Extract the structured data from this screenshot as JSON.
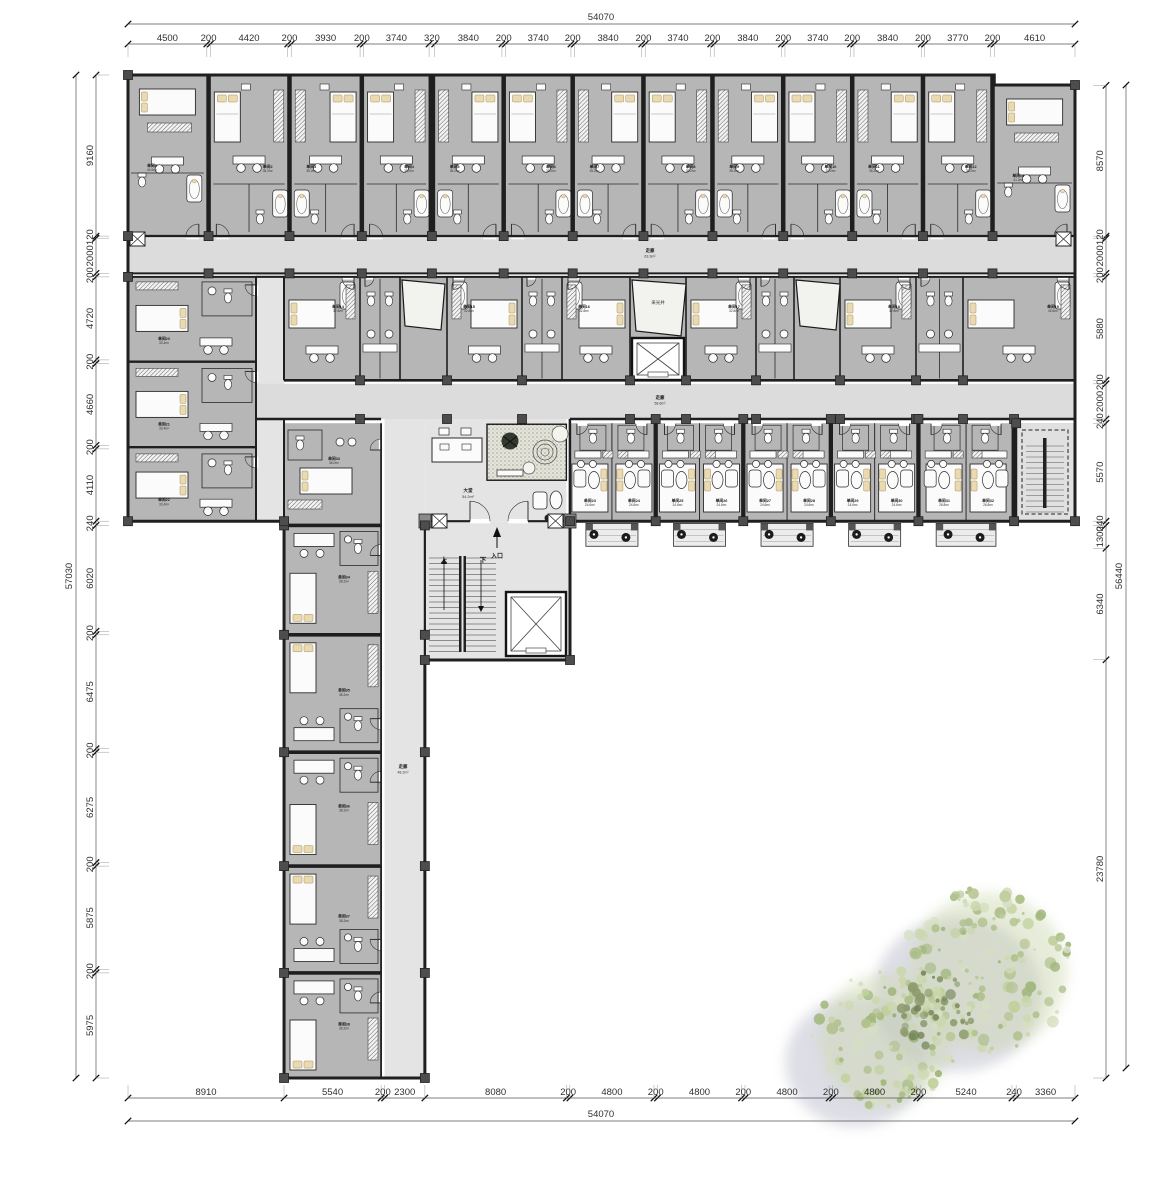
{
  "colors": {
    "wall": "#1f1f1f",
    "room_fill": "#b6b6b6",
    "corridor_fill": "#dcdcdc",
    "hall_fill": "#e4e4e4",
    "furniture": "#fbfbfb",
    "pillow": "#e9dab2",
    "column": "#4d4d4d",
    "dim_text": "#2f2f2f",
    "tree_greens": [
      "#ccd7ae",
      "#c2d09e",
      "#d6dfc2",
      "#b2c28e",
      "#a3b87f"
    ],
    "tree_moss": "#8d9c6d",
    "tree_shadow": "#bcbdcc"
  },
  "dimensions": {
    "top": {
      "total": "54070",
      "segments": [
        4500,
        200,
        4420,
        200,
        3930,
        200,
        3740,
        320,
        3840,
        200,
        3740,
        200,
        3840,
        200,
        3740,
        200,
        3840,
        200,
        3740,
        200,
        3840,
        200,
        3770,
        200,
        4610
      ]
    },
    "bottom": {
      "total": "54070",
      "segments": [
        8910,
        5540,
        200,
        2300,
        8080,
        200,
        4800,
        200,
        4800,
        200,
        4800,
        200,
        4800,
        200,
        5240,
        240,
        3360
      ]
    },
    "left": {
      "total": "57030",
      "segments": [
        9160,
        120,
        2000,
        200,
        4720,
        200,
        4660,
        200,
        4110,
        240,
        6020,
        200,
        6475,
        200,
        6275,
        200,
        5875,
        200,
        5975
      ]
    },
    "right": {
      "total": "56440",
      "segments": [
        8570,
        120,
        2000,
        200,
        5880,
        200,
        2000,
        240,
        5570,
        240,
        1300,
        6340,
        23780
      ]
    }
  },
  "labels": {
    "entrance": "入口",
    "up": "上",
    "down": "下",
    "lightwell": "采光井",
    "corridor": "走廊",
    "corridor_areas": [
      "63.3m²",
      "58.6m²",
      "48.2m²"
    ],
    "lobby": "大堂",
    "lobby_area": "54.2m²"
  },
  "rooms": {
    "top": [
      {
        "label": "单间1",
        "area": "40.6m²"
      },
      {
        "label": "单间2",
        "area": "35.2m²"
      },
      {
        "label": "单间3",
        "area": "35.2m²"
      },
      {
        "label": "单间4",
        "area": "35.2m²"
      },
      {
        "label": "单间5",
        "area": "35.2m²"
      },
      {
        "label": "单间6",
        "area": "35.2m²"
      },
      {
        "label": "单间7",
        "area": "35.2m²"
      },
      {
        "label": "单间8",
        "area": "35.2m²"
      },
      {
        "label": "单间9",
        "area": "35.2m²"
      },
      {
        "label": "单间10",
        "area": "35.2m²"
      },
      {
        "label": "单间11",
        "area": "35.2m²"
      },
      {
        "label": "单间12",
        "area": "35.2m²"
      },
      {
        "label": "单间13",
        "area": "41.2m²"
      }
    ],
    "mid": [
      {
        "label": "单间14",
        "area": "32.8m²"
      },
      {
        "label": "单间15",
        "area": "32.8m²"
      },
      {
        "label": "单间16",
        "area": "32.8m²"
      },
      {
        "label": "单间17",
        "area": "32.8m²"
      },
      {
        "label": "单间18",
        "area": "32.8m²"
      },
      {
        "label": "单间19",
        "area": "45.6m²"
      }
    ],
    "block": [
      {
        "label": "单间20",
        "area": "33.4m²"
      },
      {
        "label": "单间21",
        "area": "33.4m²"
      },
      {
        "label": "单间22",
        "area": "33.4m²"
      }
    ],
    "low": [
      {
        "label": "单间23",
        "area": "24.6m²"
      },
      {
        "label": "单间24",
        "area": "24.6m²"
      },
      {
        "label": "单间25",
        "area": "24.6m²"
      },
      {
        "label": "单间26",
        "area": "24.6m²"
      },
      {
        "label": "单间27",
        "area": "24.6m²"
      },
      {
        "label": "单间28",
        "area": "24.6m²"
      },
      {
        "label": "单间29",
        "area": "24.6m²"
      },
      {
        "label": "单间30",
        "area": "24.6m²"
      },
      {
        "label": "单间31",
        "area": "26.8m²"
      },
      {
        "label": "单间32",
        "area": "26.8m²"
      }
    ],
    "wing": [
      {
        "label": "单间33",
        "area": "36.0m²"
      },
      {
        "label": "单间34",
        "area": "38.2m²"
      },
      {
        "label": "单间35",
        "area": "38.2m²"
      },
      {
        "label": "单间36",
        "area": "38.2m²"
      },
      {
        "label": "单间37",
        "area": "38.2m²"
      },
      {
        "label": "单间38",
        "area": "38.2m²"
      }
    ]
  },
  "tree": {
    "canopies": [
      {
        "cx": 988,
        "cy": 972,
        "r": 86,
        "dots": 150
      },
      {
        "cx": 886,
        "cy": 1040,
        "r": 72,
        "dots": 110
      }
    ],
    "moss": {
      "cx": 932,
      "cy": 1012,
      "r": 40,
      "dots": 45
    },
    "shadow_offset": [
      -30,
      22
    ]
  }
}
